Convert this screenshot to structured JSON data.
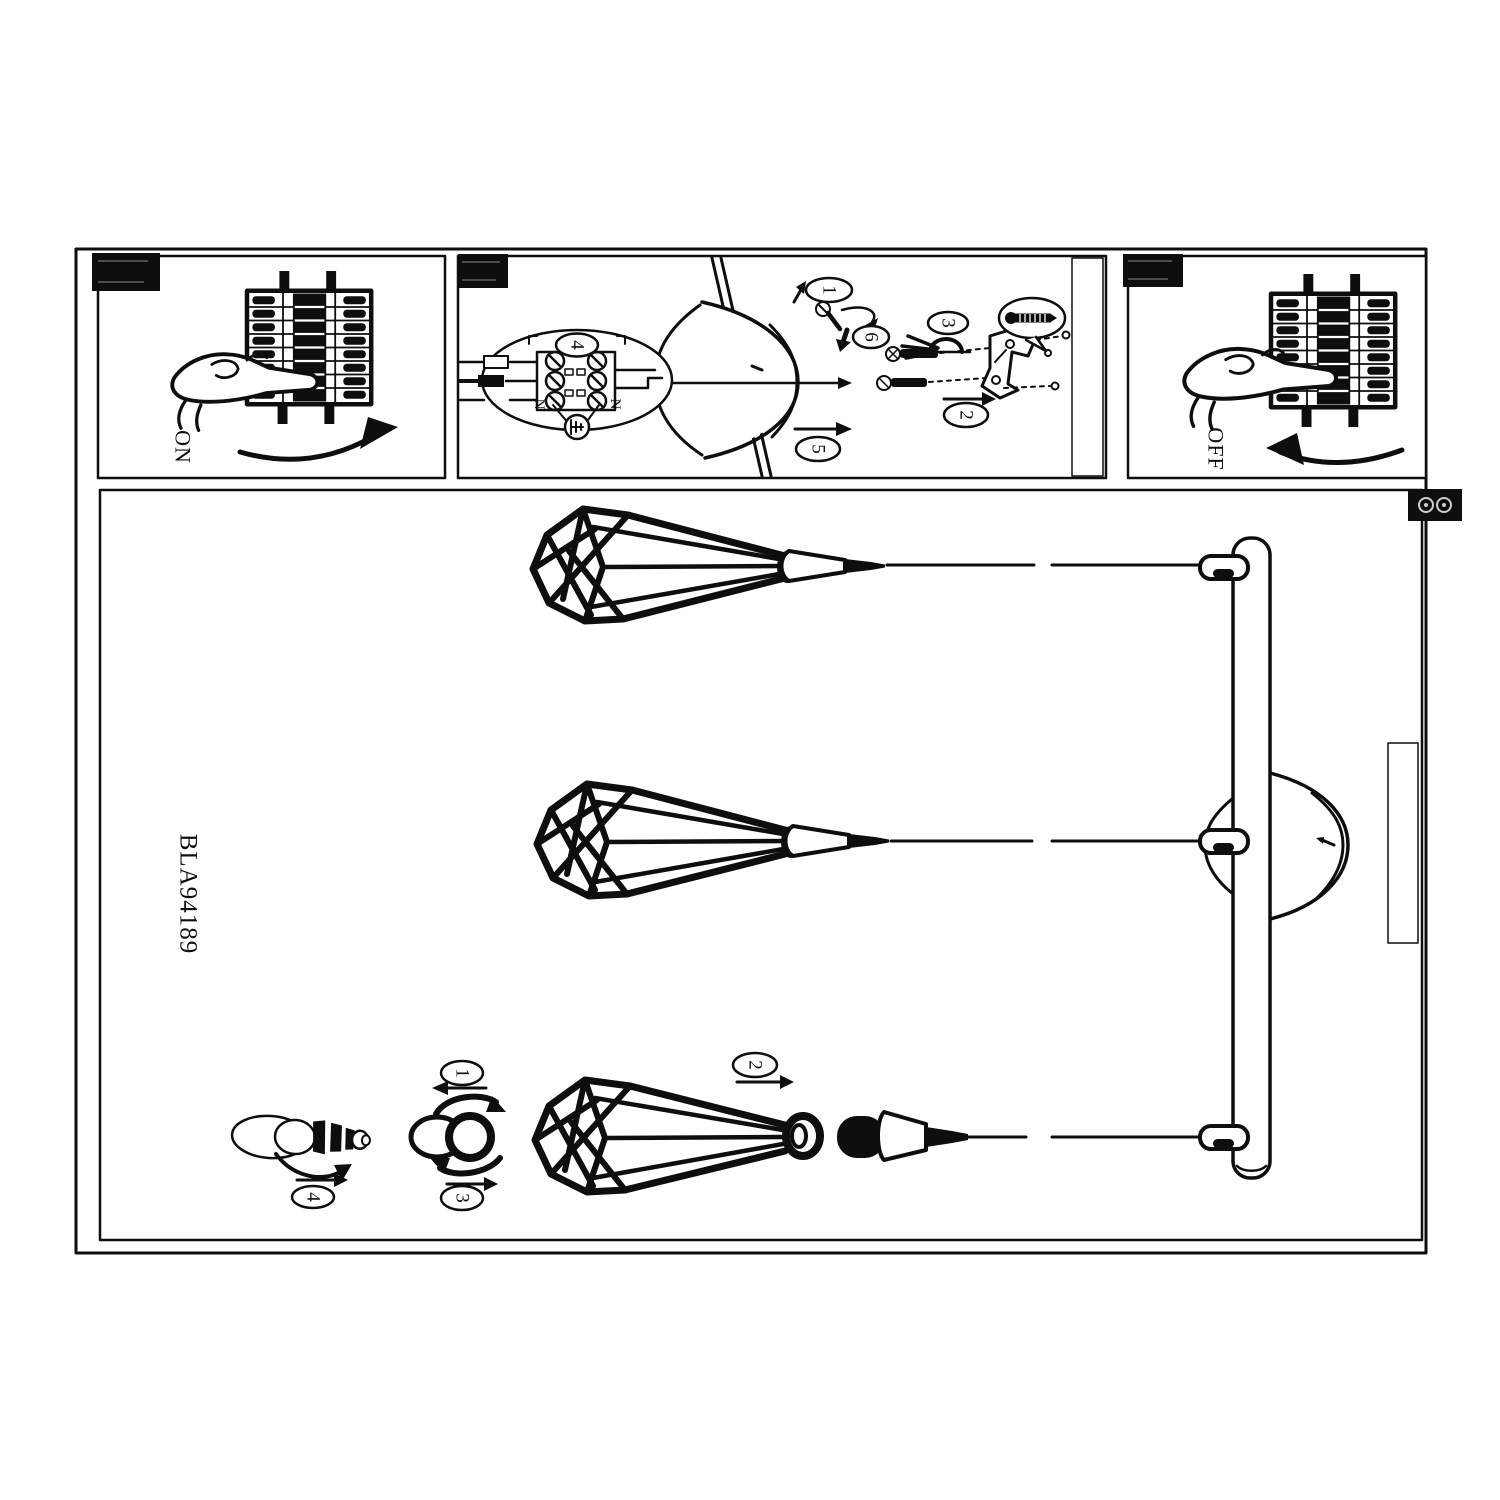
{
  "labels": {
    "model_number": "BLA94189",
    "power_on": "ON",
    "power_off": "OFF"
  },
  "wiring_panel": {
    "terminal_step": "4",
    "neutral_left": "N",
    "neutral_right": "N",
    "step_screw": "1",
    "step_bracket": "2",
    "step_clamp": "3",
    "step_canopy": "5",
    "step_fix": "6"
  },
  "assembly_panel": {
    "step_ring_loosen": "1",
    "step_insert_socket": "2",
    "step_ring_tighten": "3",
    "step_bulb": "4"
  }
}
